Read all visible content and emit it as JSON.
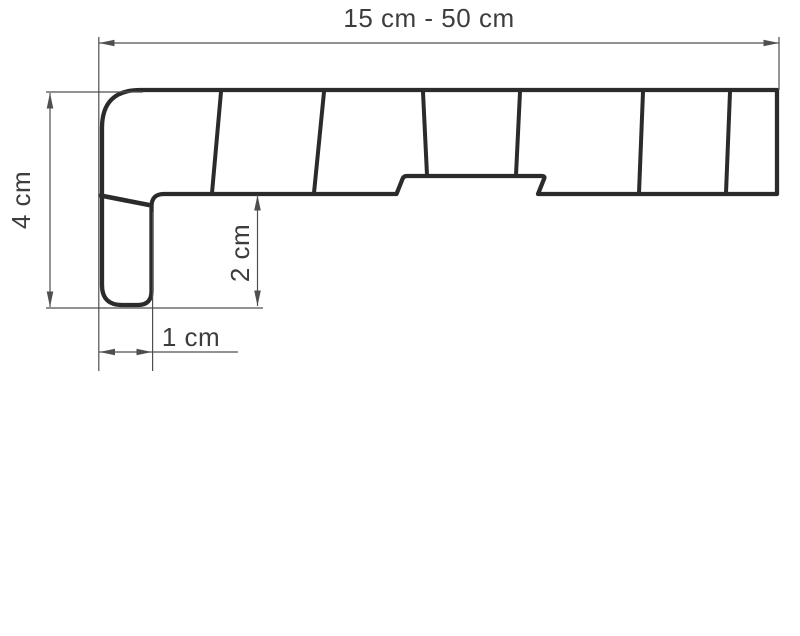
{
  "drawing": {
    "type": "windowsill-profile-cross-section",
    "labels": {
      "width_range": "15 cm - 50 cm",
      "total_height": "4 cm",
      "front_edge_height": "2 cm",
      "front_edge_width": "1 cm"
    },
    "dimensions": [
      {
        "name": "overall-width",
        "label": "15 cm - 50 cm",
        "orientation": "horizontal"
      },
      {
        "name": "overall-height",
        "label": "4 cm",
        "orientation": "vertical"
      },
      {
        "name": "front-nose-height",
        "label": "2 cm",
        "orientation": "vertical"
      },
      {
        "name": "front-nose-width",
        "label": "1 cm",
        "orientation": "horizontal"
      }
    ],
    "colors": {
      "background": "#ffffff",
      "profile_outline": "#2b2b2b",
      "dimension_lines": "#4f4f4f",
      "label_text": "#3d3d3d"
    }
  }
}
